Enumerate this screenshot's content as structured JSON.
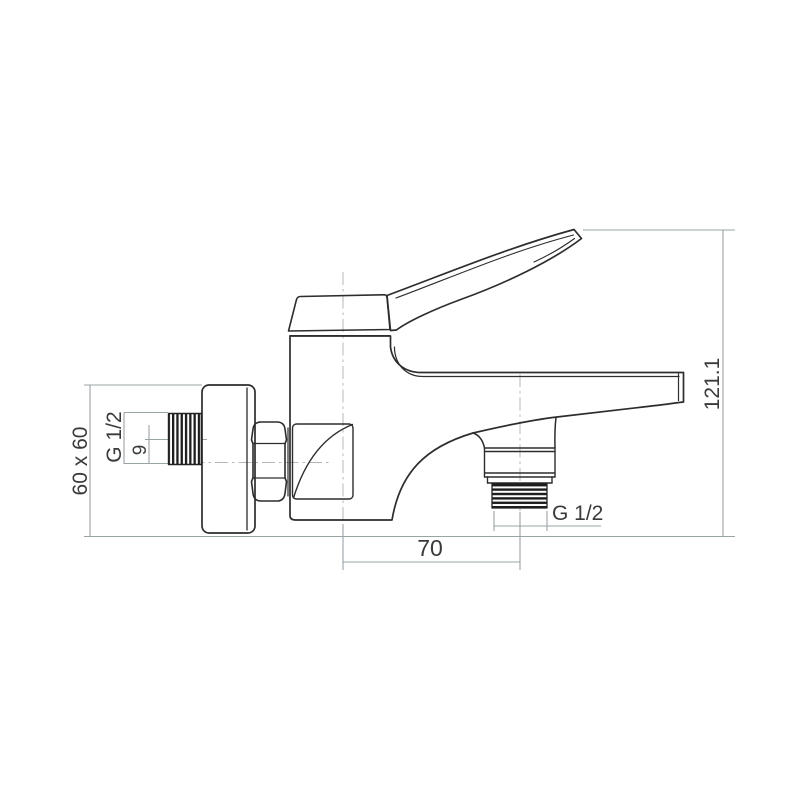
{
  "drawing": {
    "type": "technical-dimension-drawing",
    "subject": "wall-mounted single-lever bath shower mixer, side view",
    "dimensions": {
      "flange_size": "60 x 60",
      "inlet_thread": "G 1/2",
      "inlet_offset": "9",
      "total_height": "121.1",
      "outlet_distance": "70",
      "outlet_thread": "G 1/2"
    },
    "colors": {
      "background": "#ffffff",
      "outline": "#2d2d2d",
      "dimension_line": "#9aa3a6",
      "centerline": "#b5b8ba",
      "text": "#3a3a3a",
      "thread_fill": "#1d1d1d"
    }
  }
}
